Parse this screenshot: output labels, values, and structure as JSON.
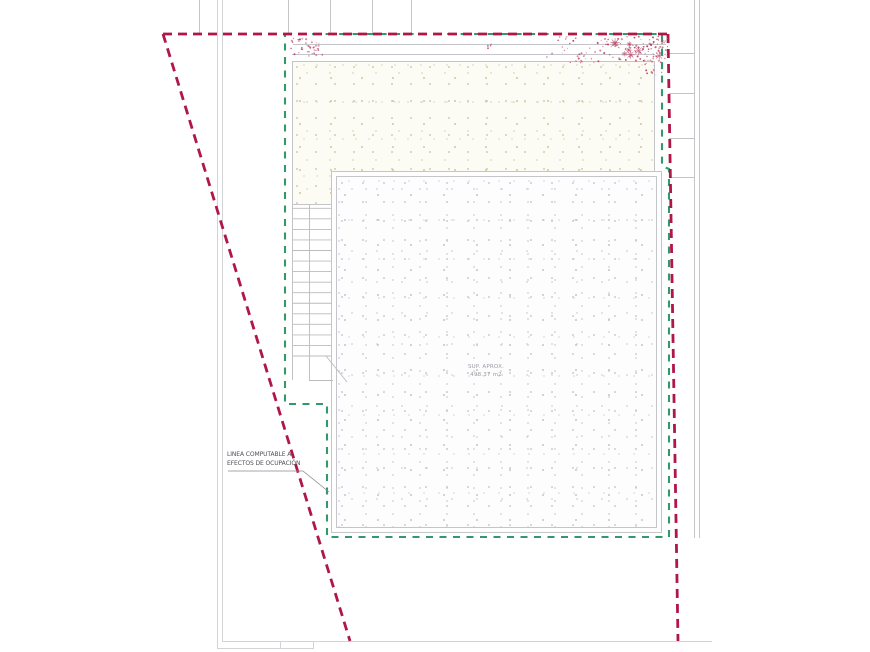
{
  "labels": {
    "occupancy_line": {
      "line1": "LINEA COMPUTABLE A",
      "line2": "EFECTOS DE OCUPACIÓN"
    },
    "area": {
      "line1": "SUP. APROX.",
      "line2": "498.37 m2"
    }
  },
  "colors": {
    "boundary_red": "#b01648",
    "computable_green": "#33996b",
    "structure_gray": "#c4c5c8",
    "faint_gray": "#d2d3d6",
    "stair_gray": "#bbbcbf",
    "stipple_gray": "#c4c4cc",
    "stipple_olive": "#c9c8a2",
    "vegetation_red": "#b84265",
    "label_text": "#4f4f57",
    "area_text": "#9b9ba3",
    "background": "#ffffff"
  }
}
